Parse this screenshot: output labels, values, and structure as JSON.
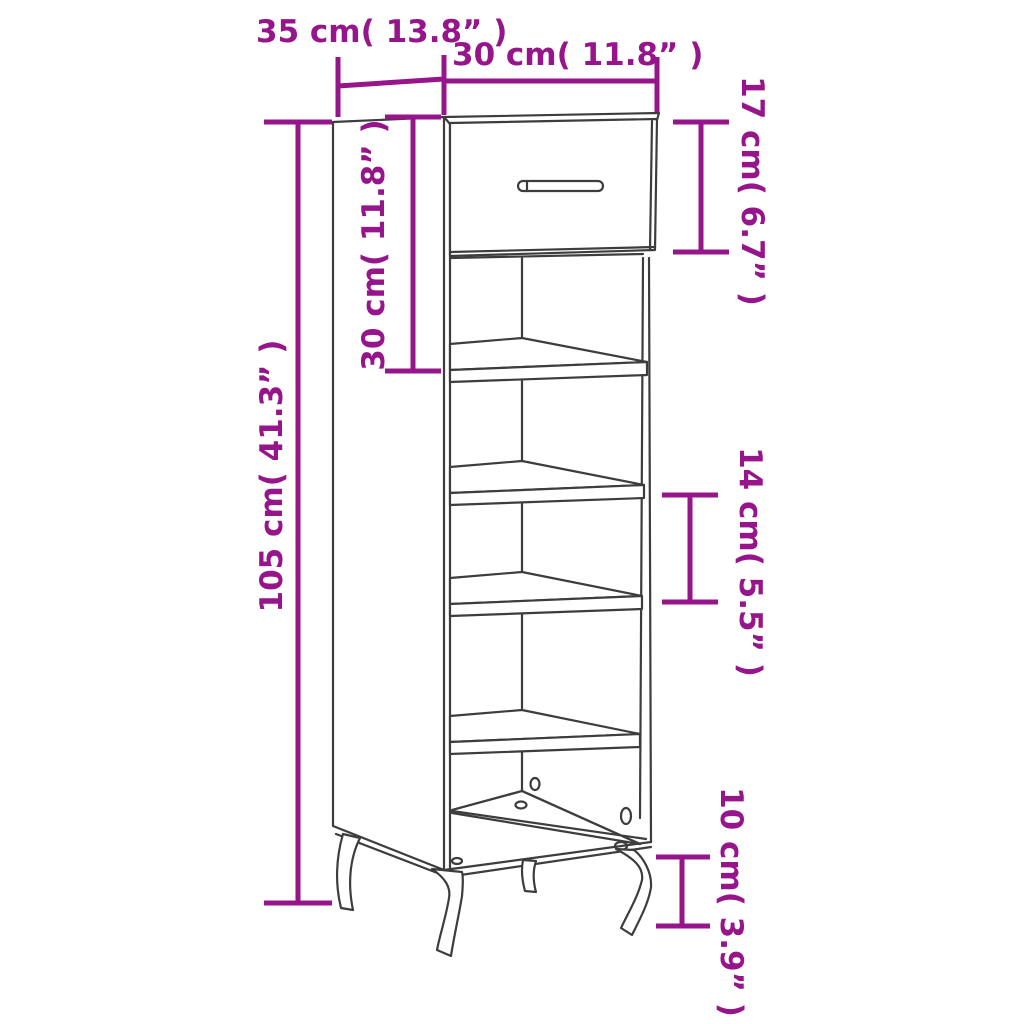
{
  "colors": {
    "accent": "#96158B",
    "line": "#3D3D3D",
    "background": "#ffffff"
  },
  "diagram": {
    "dimensions": {
      "depth": {
        "label": "35 cm( 13.8” )"
      },
      "width": {
        "label": "30 cm( 11.8” )"
      },
      "drawer_height": {
        "label": "17 cm( 6.7” )"
      },
      "top_section_height": {
        "label": "30 cm( 11.8” )"
      },
      "total_height": {
        "label": "105 cm( 41.3” )"
      },
      "shelf_gap": {
        "label": "14 cm( 5.5” )"
      },
      "leg_height": {
        "label": "10 cm( 3.9” )"
      }
    }
  }
}
